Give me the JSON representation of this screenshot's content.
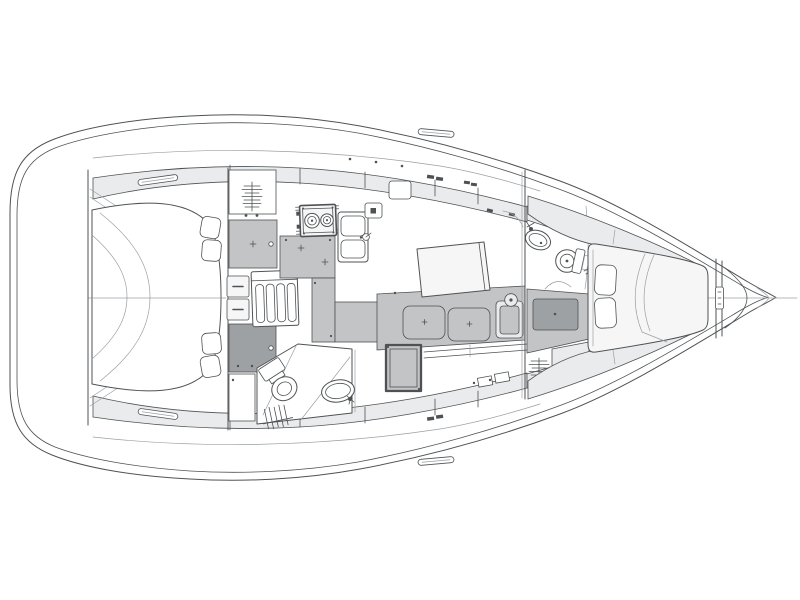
{
  "diagram": {
    "type": "yacht-interior-layout-plan",
    "view": "top-down",
    "bow_direction": "right",
    "stern_direction": "left"
  },
  "colors": {
    "paper": "#ffffff",
    "line": "#4f5254",
    "line_soft": "#9aa0a4",
    "fill_white": "#ffffff",
    "fill_panel": "#f6f6f6",
    "fill_light": "#eaebec",
    "fill_mid": "#c2c4c5",
    "fill_dark": "#9da1a3"
  },
  "regions": {
    "stern": [
      "transom",
      "swim-platform"
    ],
    "aft_cabin": [
      "full-beam-double-berth",
      "pillows",
      "duvet-folds",
      "hanging-locker",
      "cabinet",
      "step-treads"
    ],
    "companionway": [
      "stairs-with-treads"
    ],
    "galley": [
      "two-burner-stove",
      "double-sink",
      "faucet",
      "worktop-counters",
      "appliance-box"
    ],
    "saloon": [
      "dining-table",
      "settee-band",
      "seat-cushions",
      "end-sink-unit",
      "fridge-box",
      "stbd-berth-bench"
    ],
    "aft_head": [
      "toilet",
      "washbasin",
      "faucet",
      "shower-divider",
      "hanging-locker"
    ],
    "forward_head": [
      "toilet",
      "washbasin",
      "faucet",
      "door-swing-arc"
    ],
    "forward_cabin": [
      "v-berth",
      "pillows",
      "duvet-folds",
      "side-shelves",
      "dresser-step",
      "hanging-locker"
    ],
    "bow": [
      "collision-bulkhead",
      "hatch-latch",
      "anchor-locker"
    ]
  },
  "icon_names": [
    "stove-icon",
    "double-sink-icon",
    "faucet-icon",
    "toilet-icon",
    "washbasin-icon",
    "stairs-icon",
    "hanging-locker-icon",
    "pillow-icon",
    "fridge-icon",
    "table-icon",
    "settee-cushion-icon",
    "cleat-icon",
    "anchor-locker-icon",
    "door-swing-icon"
  ]
}
